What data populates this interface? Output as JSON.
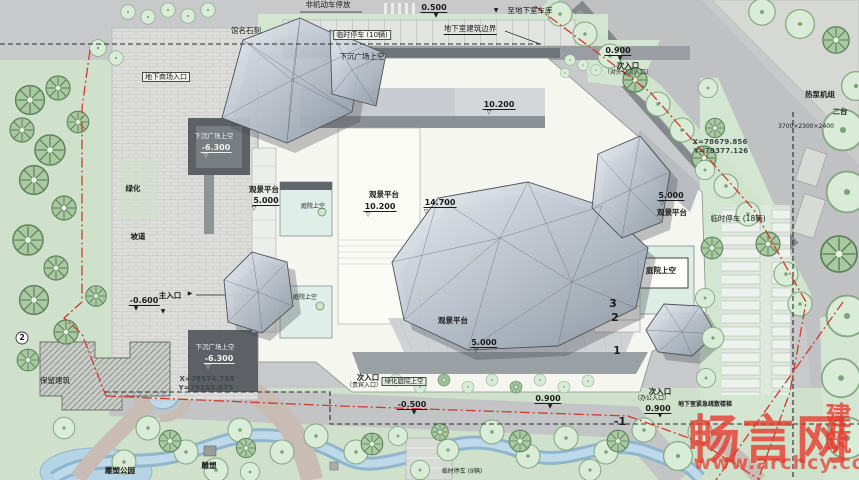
{
  "colors": {
    "boundary_red": "#d23a2e",
    "watermark_red": "#e6392e",
    "underground_boundary_black": "#2a2a2a",
    "park_green": "#cfe1ca",
    "verge_green": "#d3e6d1",
    "water_blue": "#b5d4e6",
    "plaza_gray": "#dcdcda",
    "road_gray": "#c7c9cb",
    "building_white": "#f6f6f1",
    "crystal_gray": "#aab2bc",
    "text_dark": "#1c1c1c"
  },
  "watermark": {
    "brand": "畅言网",
    "suffix": "建筑",
    "url": "www.archcy.com"
  },
  "plan": {
    "labels": [
      {
        "t": "非机动车停放",
        "x": 328,
        "y": 1,
        "n": "bicycle-parking-label"
      },
      {
        "t": "馆名石刻",
        "x": 246,
        "y": 27,
        "n": "stone-inscription-label"
      },
      {
        "t": "0.500",
        "x": 434,
        "y": 3,
        "c": "elev",
        "n": "elevation-0500"
      },
      {
        "t": "▼",
        "x": 436,
        "y": 13,
        "c": "tri"
      },
      {
        "t": "▼",
        "x": 496,
        "y": 8,
        "c": "tri"
      },
      {
        "t": "至地下室车库",
        "x": 530,
        "y": 7,
        "n": "to-basement-garage-label"
      },
      {
        "t": "地下室建筑边界",
        "x": 470,
        "y": 25,
        "c": "u",
        "n": "basement-boundary-label"
      },
      {
        "t": "临时停车 (10辆)",
        "x": 362,
        "y": 30,
        "c": "box",
        "n": "temp-parking-10-label"
      },
      {
        "t": "下沉广场上空",
        "x": 362,
        "y": 53,
        "n": "sunken-plaza-label"
      },
      {
        "t": "地下商场入口",
        "x": 166,
        "y": 72,
        "c": "box",
        "n": "underground-mall-entrance-label"
      },
      {
        "t": "下沉广场上空",
        "x": 214,
        "y": 133,
        "c": "w tiny2"
      },
      {
        "t": "-6.300",
        "x": 216,
        "y": 143,
        "c": "elev w",
        "n": "elevation-minus-6300"
      },
      {
        "t": "▽",
        "x": 206,
        "y": 153,
        "c": "tri w"
      },
      {
        "t": "绿化",
        "x": 133,
        "y": 185,
        "c": "b",
        "n": "greenery-label"
      },
      {
        "t": "坡道",
        "x": 138,
        "y": 233,
        "c": "b",
        "n": "ramp-label"
      },
      {
        "t": "观景平台",
        "x": 264,
        "y": 186,
        "c": "b",
        "n": "view-deck-label"
      },
      {
        "t": "5.000",
        "x": 266,
        "y": 196,
        "c": "elev"
      },
      {
        "t": "▽",
        "x": 254,
        "y": 206,
        "c": "tri"
      },
      {
        "t": "庭院上空",
        "x": 313,
        "y": 204,
        "c": "tiny"
      },
      {
        "t": "观景平台",
        "x": 384,
        "y": 191,
        "c": "b"
      },
      {
        "t": "10.200",
        "x": 380,
        "y": 202,
        "c": "elev"
      },
      {
        "t": "▽",
        "x": 368,
        "y": 212,
        "c": "tri"
      },
      {
        "t": "14.700",
        "x": 440,
        "y": 198,
        "c": "elev",
        "n": "elevation-14700"
      },
      {
        "t": "▽",
        "x": 426,
        "y": 209,
        "c": "tri"
      },
      {
        "t": "10.200",
        "x": 499,
        "y": 100,
        "c": "elev"
      },
      {
        "t": "▽",
        "x": 489,
        "y": 110,
        "c": "tri"
      },
      {
        "t": "庭院上空",
        "x": 305,
        "y": 295,
        "c": "tiny"
      },
      {
        "t": "观景平台",
        "x": 453,
        "y": 317,
        "c": "b"
      },
      {
        "t": "5.000",
        "x": 484,
        "y": 338,
        "c": "elev"
      },
      {
        "t": "▽",
        "x": 476,
        "y": 348,
        "c": "tri"
      },
      {
        "t": "5.000",
        "x": 671,
        "y": 191,
        "c": "elev"
      },
      {
        "t": "▽",
        "x": 662,
        "y": 201,
        "c": "tri"
      },
      {
        "t": "观景平台",
        "x": 672,
        "y": 209,
        "c": "b"
      },
      {
        "t": "庭院上空",
        "x": 661,
        "y": 267,
        "c": "b",
        "n": "courtyard-label"
      },
      {
        "t": "临时停车 (18辆)",
        "x": 738,
        "y": 215,
        "n": "temp-parking-18-label"
      },
      {
        "t": "X=78679.856",
        "x": 720,
        "y": 138,
        "c": "coord",
        "n": "coordinate-x-ne"
      },
      {
        "t": "Y=79377.126",
        "x": 721,
        "y": 147,
        "c": "coord",
        "n": "coordinate-y-ne"
      },
      {
        "t": "热泵机组",
        "x": 820,
        "y": 91,
        "c": "b",
        "n": "heat-pump-label"
      },
      {
        "t": "二台",
        "x": 840,
        "y": 108,
        "c": "b"
      },
      {
        "t": "3700×2300×2400",
        "x": 806,
        "y": 124,
        "c": "tiny"
      },
      {
        "t": "0.900",
        "x": 618,
        "y": 46,
        "c": "elev"
      },
      {
        "t": "▼",
        "x": 620,
        "y": 56,
        "c": "tri"
      },
      {
        "t": "次入口",
        "x": 628,
        "y": 62,
        "c": "b",
        "n": "secondary-entrance-ne-label"
      },
      {
        "t": "（对外交流入口）",
        "x": 628,
        "y": 70,
        "c": "tiny"
      },
      {
        "t": "主入口",
        "x": 170,
        "y": 292,
        "c": "b",
        "n": "main-entrance-label"
      },
      {
        "t": "▶",
        "x": 190,
        "y": 291,
        "c": "tri"
      },
      {
        "t": "-0.600",
        "x": 144,
        "y": 296,
        "c": "elev"
      },
      {
        "t": "▼",
        "x": 136,
        "y": 306,
        "c": "tri"
      },
      {
        "t": "▼",
        "x": 163,
        "y": 309,
        "c": "tri"
      },
      {
        "t": "下沉广场上空",
        "x": 215,
        "y": 344,
        "c": "w tiny2"
      },
      {
        "t": "-6.300",
        "x": 219,
        "y": 354,
        "c": "elev w"
      },
      {
        "t": "▽",
        "x": 208,
        "y": 364,
        "c": "tri w"
      },
      {
        "t": "X=78574.758",
        "x": 207,
        "y": 375,
        "c": "coord",
        "n": "coordinate-x-sw"
      },
      {
        "t": "Y=79163.075",
        "x": 206,
        "y": 384,
        "c": "coord",
        "n": "coordinate-y-sw"
      },
      {
        "t": "次入口",
        "x": 368,
        "y": 374,
        "c": "b",
        "n": "secondary-entrance-vip-label"
      },
      {
        "t": "（贵宾入口）",
        "x": 364,
        "y": 383,
        "c": "tiny"
      },
      {
        "t": "绿化庭院上空",
        "x": 404,
        "y": 377,
        "c": "boxg",
        "n": "green-courtyard-label"
      },
      {
        "t": "-0.500",
        "x": 412,
        "y": 400,
        "c": "elev"
      },
      {
        "t": "▼",
        "x": 414,
        "y": 410,
        "c": "tri"
      },
      {
        "t": "0.900",
        "x": 548,
        "y": 394,
        "c": "elev"
      },
      {
        "t": "▼",
        "x": 550,
        "y": 404,
        "c": "tri"
      },
      {
        "t": "-1",
        "x": 620,
        "y": 416,
        "c": "num",
        "n": "basement-level-marker"
      },
      {
        "t": "次入口",
        "x": 660,
        "y": 388,
        "c": "b",
        "n": "secondary-entrance-office-label"
      },
      {
        "t": "（办公入口）",
        "x": 652,
        "y": 396,
        "c": "tiny"
      },
      {
        "t": "0.900",
        "x": 658,
        "y": 404,
        "c": "elev"
      },
      {
        "t": "▼",
        "x": 660,
        "y": 413,
        "c": "tri"
      },
      {
        "t": "地下室紧急疏散楼梯",
        "x": 705,
        "y": 402,
        "c": "tiny b2",
        "n": "evacuation-stair-label"
      },
      {
        "t": "临时停车 (9辆)",
        "x": 462,
        "y": 469,
        "c": "tiny",
        "n": "temp-parking-9-label"
      },
      {
        "t": "保留建筑",
        "x": 55,
        "y": 377,
        "n": "preserved-building-label"
      },
      {
        "t": "雕塑公园",
        "x": 120,
        "y": 467,
        "c": "b",
        "n": "sculpture-park-label"
      },
      {
        "t": "雕塑",
        "x": 209,
        "y": 462,
        "c": "b",
        "n": "sculpture-label"
      },
      {
        "t": "3",
        "x": 613,
        "y": 298,
        "c": "num",
        "n": "storey-marker-3"
      },
      {
        "t": "2",
        "x": 615,
        "y": 312,
        "c": "num",
        "n": "storey-marker-2"
      },
      {
        "t": "1",
        "x": 617,
        "y": 345,
        "c": "num",
        "n": "storey-marker-1"
      },
      {
        "t": "2",
        "x": 22,
        "y": 333,
        "c": "gnum",
        "n": "grid-bubble-2"
      }
    ]
  }
}
